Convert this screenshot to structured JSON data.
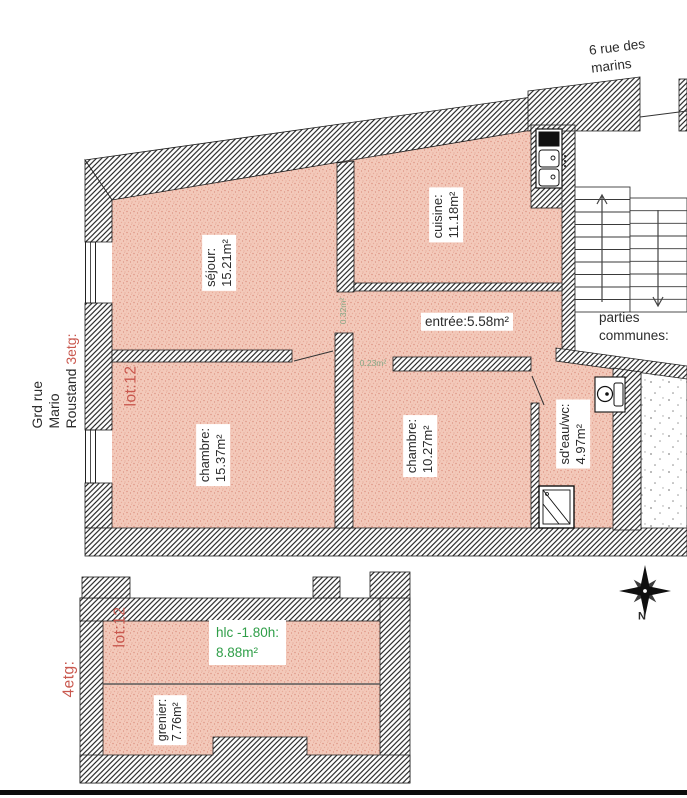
{
  "plan_upper": {
    "floor_label": "3etg:",
    "lot_label": "lot:12",
    "street_label": "6 rue des marins",
    "address": {
      "line1": "Grd rue",
      "line2": "Mario",
      "line3": "Roustand"
    },
    "rooms": {
      "sejour": {
        "name": "séjour:",
        "area": "15.21m²"
      },
      "cuisine": {
        "name": "cuisine:",
        "area": "11.18m²"
      },
      "entree": {
        "label": "entrée:5.58m²"
      },
      "chambre1": {
        "name": "chambre:",
        "area": "15.37m²"
      },
      "chambre2": {
        "name": "chambre:",
        "area": "10.27m²"
      },
      "sdeau": {
        "name": "sd'eau/wc:",
        "area": "4.97m²"
      }
    },
    "small_areas": {
      "left": "0.32m²",
      "right": "0.23m²"
    },
    "common_area": {
      "line1": "parties",
      "line2": "communes:"
    }
  },
  "plan_lower": {
    "floor_label": "4etg:",
    "lot_label": "lot:12",
    "rooms": {
      "hlc": {
        "line1": "hlc -1.80h:",
        "line2": "8.88m²"
      },
      "grenier": {
        "name": "grenier:",
        "area": "7.76m²"
      }
    }
  },
  "compass": {
    "north_label": "N"
  },
  "colors": {
    "room_fill": "#f3c9ba",
    "lot_red": "#c9584e",
    "hlc_green": "#2f9e48",
    "small_area_green": "#85a886",
    "ink": "#2b2b2b"
  }
}
